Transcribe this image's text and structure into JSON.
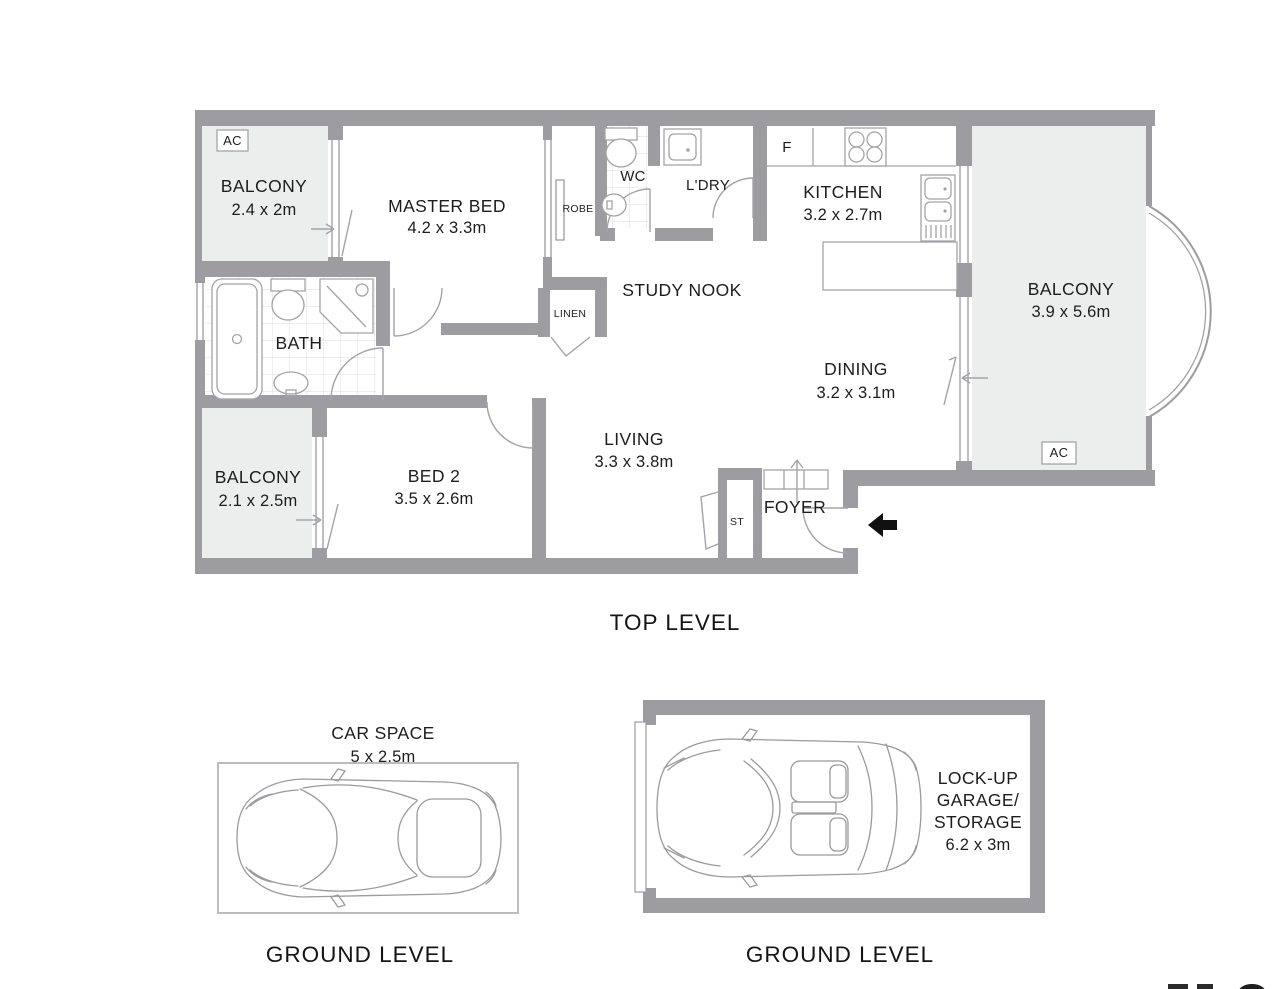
{
  "colors": {
    "wall": "#9c9ca1",
    "balcony_fill": "#ebeeec",
    "text": "#1d1d1f"
  },
  "top_level": {
    "caption": "TOP LEVEL",
    "ac": "AC",
    "balcony_top_left": {
      "name": "BALCONY",
      "dims": "2.4 x 2m"
    },
    "master_bed": {
      "name": "MASTER BED",
      "dims": "4.2 x 3.3m"
    },
    "robe": {
      "label": "ROBE"
    },
    "linen": {
      "label": "LINEN"
    },
    "wc": {
      "label": "WC"
    },
    "laundry": {
      "label": "L'DRY"
    },
    "fridge": {
      "label": "F"
    },
    "kitchen": {
      "name": "KITCHEN",
      "dims": "3.2 x 2.7m"
    },
    "balcony_right": {
      "name": "BALCONY",
      "dims": "3.9 x 5.6m"
    },
    "study_nook": {
      "name": "STUDY NOOK"
    },
    "dining": {
      "name": "DINING",
      "dims": "3.2 x 3.1m"
    },
    "bath": {
      "name": "BATH"
    },
    "balcony_lower_left": {
      "name": "BALCONY",
      "dims": "2.1 x 2.5m"
    },
    "bed2": {
      "name": "BED 2",
      "dims": "3.5 x 2.6m"
    },
    "living": {
      "name": "LIVING",
      "dims": "3.3 x 3.8m"
    },
    "storage": {
      "label": "ST"
    },
    "foyer": {
      "name": "FOYER"
    }
  },
  "car_space": {
    "name": "CAR SPACE",
    "dims": "5 x 2.5m",
    "caption": "GROUND LEVEL"
  },
  "garage": {
    "lines": [
      "LOCK-UP",
      "GARAGE/",
      "STORAGE",
      "6.2 x 3m"
    ],
    "caption": "GROUND LEVEL"
  }
}
